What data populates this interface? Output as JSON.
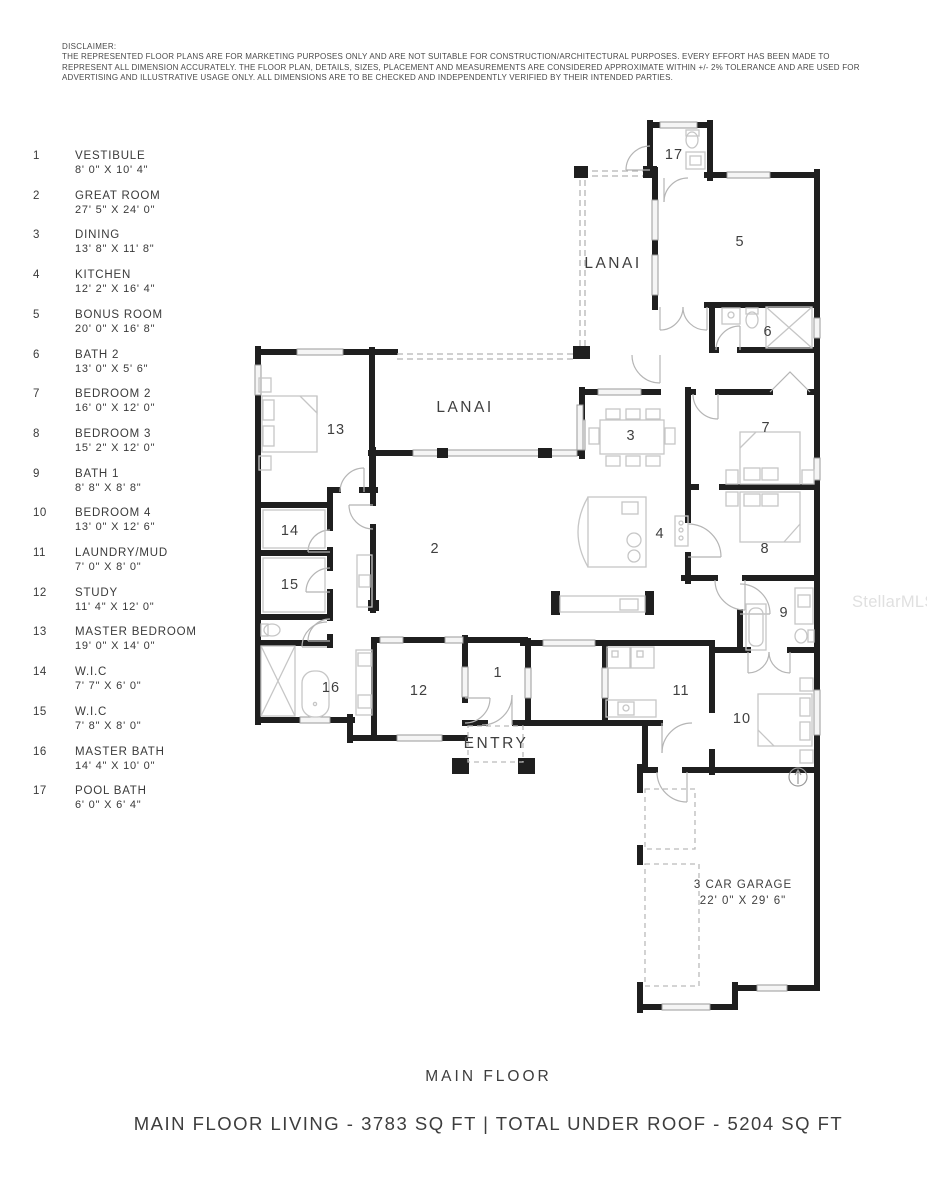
{
  "disclaimer": {
    "title": "DISCLAIMER:",
    "body": "THE REPRESENTED FLOOR PLANS ARE FOR MARKETING PURPOSES ONLY AND ARE NOT SUITABLE FOR CONSTRUCTION/ARCHITECTURAL PURPOSES. EVERY EFFORT HAS BEEN MADE TO REPRESENT ALL DIMENSION ACCURATELY.  THE FLOOR PLAN, DETAILS, SIZES, PLACEMENT AND MEASUREMENTS ARE CONSIDERED APPROXIMATE WITHIN +/- 2% TOLERANCE AND ARE USED FOR ADVERTISING AND ILLUSTRATIVE USAGE ONLY. ALL DIMENSIONS ARE TO BE CHECKED AND INDEPENDENTLY VERIFIED BY THEIR INTENDED PARTIES."
  },
  "legend": {
    "items": [
      {
        "num": "1",
        "name": "VESTIBULE",
        "dims": "8' 0\" X 10' 4\""
      },
      {
        "num": "2",
        "name": "GREAT ROOM",
        "dims": "27' 5\" X 24' 0\""
      },
      {
        "num": "3",
        "name": "DINING",
        "dims": "13' 8\" X 11' 8\""
      },
      {
        "num": "4",
        "name": "KITCHEN",
        "dims": "12' 2\" X 16' 4\""
      },
      {
        "num": "5",
        "name": "BONUS ROOM",
        "dims": "20' 0\" X 16' 8\""
      },
      {
        "num": "6",
        "name": "BATH 2",
        "dims": "13' 0\" X 5' 6\""
      },
      {
        "num": "7",
        "name": "BEDROOM 2",
        "dims": "16' 0\" X 12' 0\""
      },
      {
        "num": "8",
        "name": "BEDROOM 3",
        "dims": "15' 2\" X 12' 0\""
      },
      {
        "num": "9",
        "name": "BATH 1",
        "dims": "8' 8\" X 8' 8\""
      },
      {
        "num": "10",
        "name": "BEDROOM 4",
        "dims": "13' 0\" X 12' 6\""
      },
      {
        "num": "11",
        "name": "LAUNDRY/MUD",
        "dims": "7' 0\" X 8' 0\""
      },
      {
        "num": "12",
        "name": "STUDY",
        "dims": "11' 4\" X 12' 0\""
      },
      {
        "num": "13",
        "name": "MASTER BEDROOM",
        "dims": "19' 0\" X 14' 0\""
      },
      {
        "num": "14",
        "name": "W.I.C",
        "dims": "7' 7\" X 6' 0\""
      },
      {
        "num": "15",
        "name": "W.I.C",
        "dims": "7' 8\" X 8' 0\""
      },
      {
        "num": "16",
        "name": "MASTER BATH",
        "dims": "14' 4\" X 10' 0\""
      },
      {
        "num": "17",
        "name": "POOL BATH",
        "dims": "6' 0\" X 6' 4\""
      }
    ]
  },
  "plan": {
    "room_labels": [
      {
        "num": "1",
        "x": 498,
        "y": 677
      },
      {
        "num": "2",
        "x": 435,
        "y": 553
      },
      {
        "num": "3",
        "x": 631,
        "y": 440
      },
      {
        "num": "4",
        "x": 660,
        "y": 538
      },
      {
        "num": "5",
        "x": 740,
        "y": 246
      },
      {
        "num": "6",
        "x": 768,
        "y": 336
      },
      {
        "num": "7",
        "x": 766,
        "y": 432
      },
      {
        "num": "8",
        "x": 765,
        "y": 553
      },
      {
        "num": "9",
        "x": 784,
        "y": 617
      },
      {
        "num": "10",
        "x": 742,
        "y": 723
      },
      {
        "num": "11",
        "x": 681,
        "y": 695
      },
      {
        "num": "12",
        "x": 419,
        "y": 695
      },
      {
        "num": "13",
        "x": 336,
        "y": 434
      },
      {
        "num": "14",
        "x": 290,
        "y": 535
      },
      {
        "num": "15",
        "x": 290,
        "y": 589
      },
      {
        "num": "16",
        "x": 331,
        "y": 692
      },
      {
        "num": "17",
        "x": 674,
        "y": 159
      }
    ],
    "area_labels": [
      {
        "text": "LANAI",
        "x": 613,
        "y": 268
      },
      {
        "text": "LANAI",
        "x": 465,
        "y": 412
      },
      {
        "text": "ENTRY",
        "x": 496,
        "y": 748
      }
    ],
    "garage_label": {
      "line1": "3 CAR GARAGE",
      "line2": "22' 0\" X 29' 6\"",
      "x": 743,
      "y": 888
    }
  },
  "watermark": "StellarMLS",
  "footer": {
    "floor_name": "MAIN FLOOR",
    "area_summary": "MAIN FLOOR LIVING - 3783 SQ FT | TOTAL UNDER ROOF - 5204 SQ FT"
  }
}
